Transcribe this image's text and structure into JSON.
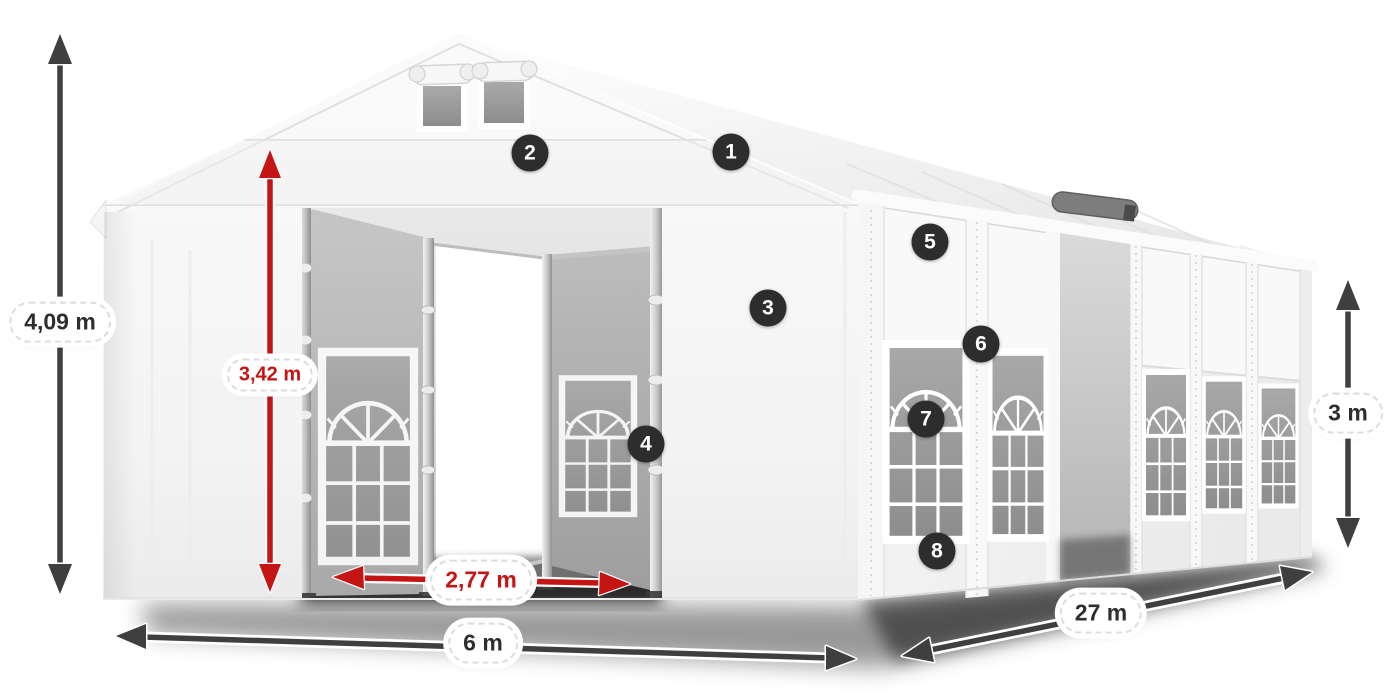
{
  "diagram": {
    "subject": "white marquee tent with dimension callouts"
  },
  "dimensions": {
    "total_height": "4,09 m",
    "entrance_height": "3,42 m",
    "entrance_width": "2,77 m",
    "front_width": "6 m",
    "length": "27 m",
    "side_height": "3 m"
  },
  "callouts": {
    "numbers": [
      "1",
      "2",
      "3",
      "4",
      "5",
      "6",
      "7",
      "8"
    ]
  },
  "colors": {
    "accent_red": "#c41414",
    "arrow_dark": "#3f3f3f",
    "badge_background": "#2d2d2d",
    "tent_white": "#f6f6f6",
    "window_glass": "#9a9a9a",
    "canvas_background": "#ffffff"
  }
}
